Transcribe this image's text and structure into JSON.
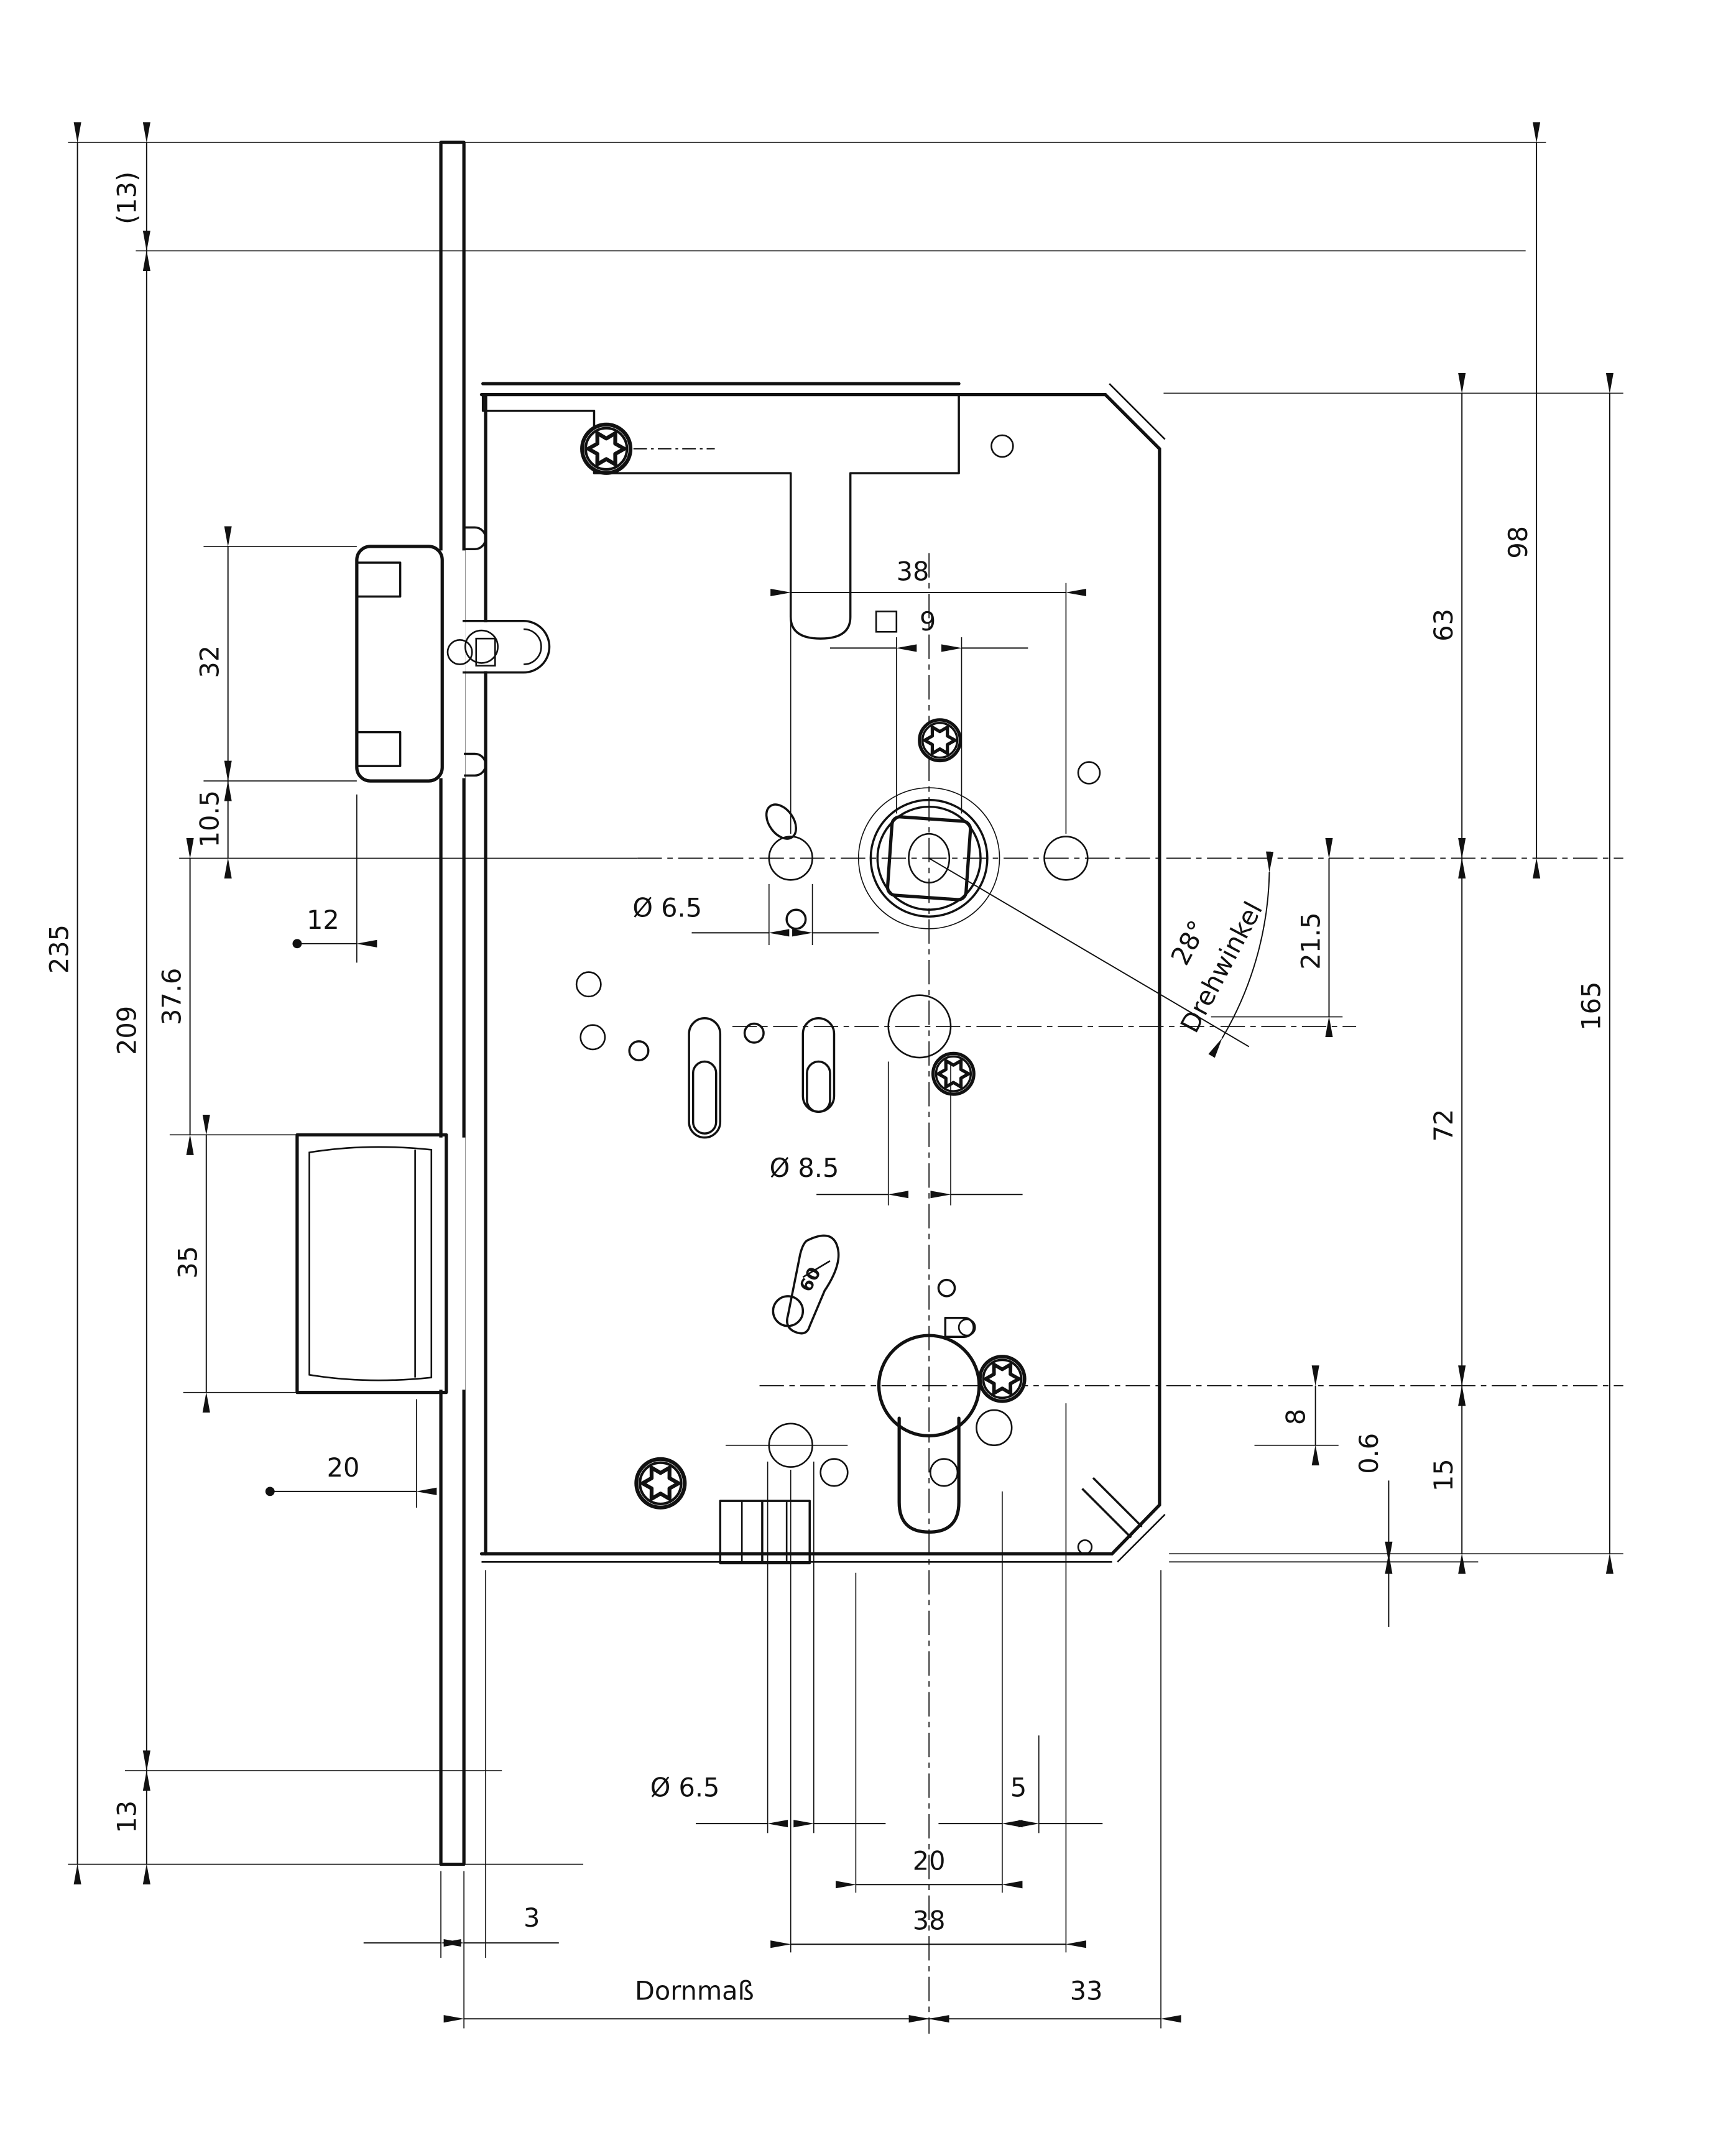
{
  "drawing": {
    "type": "mortise-lock-technical-drawing",
    "language": "de",
    "colors": {
      "line": "#111111",
      "background": "#ffffff"
    },
    "dimensions": {
      "left": {
        "overall_height": "235",
        "plate_height": "209",
        "top_offset_ref": "(13)",
        "latch_height": "32",
        "latch_to_center": "10.5",
        "latch_protrusion": "12",
        "center_to_deadbolt": "37.6",
        "deadbolt_height": "35",
        "deadbolt_throw": "20",
        "bottom_offset": "13"
      },
      "top": {
        "hole_spacing": "38",
        "square_size": "9"
      },
      "center": {
        "hole_dia_65": "Ø 6.5",
        "hole_dia_85": "Ø 8.5",
        "lever_stamp": "60"
      },
      "right": {
        "top_to_center": "98",
        "case_top_to_center": "63",
        "rotation_angle": "28°",
        "rotation_angle_label": "Drehwinkel",
        "nut_offset": "21.5",
        "case_height": "165",
        "center_to_cylinder": "72",
        "screw_offset": "8",
        "bottom_gap": "0.6",
        "cylinder_to_bottom": "15"
      },
      "bottom": {
        "hole_dia": "Ø 6.5",
        "offset_5": "5",
        "spacing_20": "20",
        "spacing_38": "38",
        "faceplate_thickness": "3",
        "backset_label": "Dornmaß",
        "center_to_case_edge": "33"
      }
    }
  }
}
